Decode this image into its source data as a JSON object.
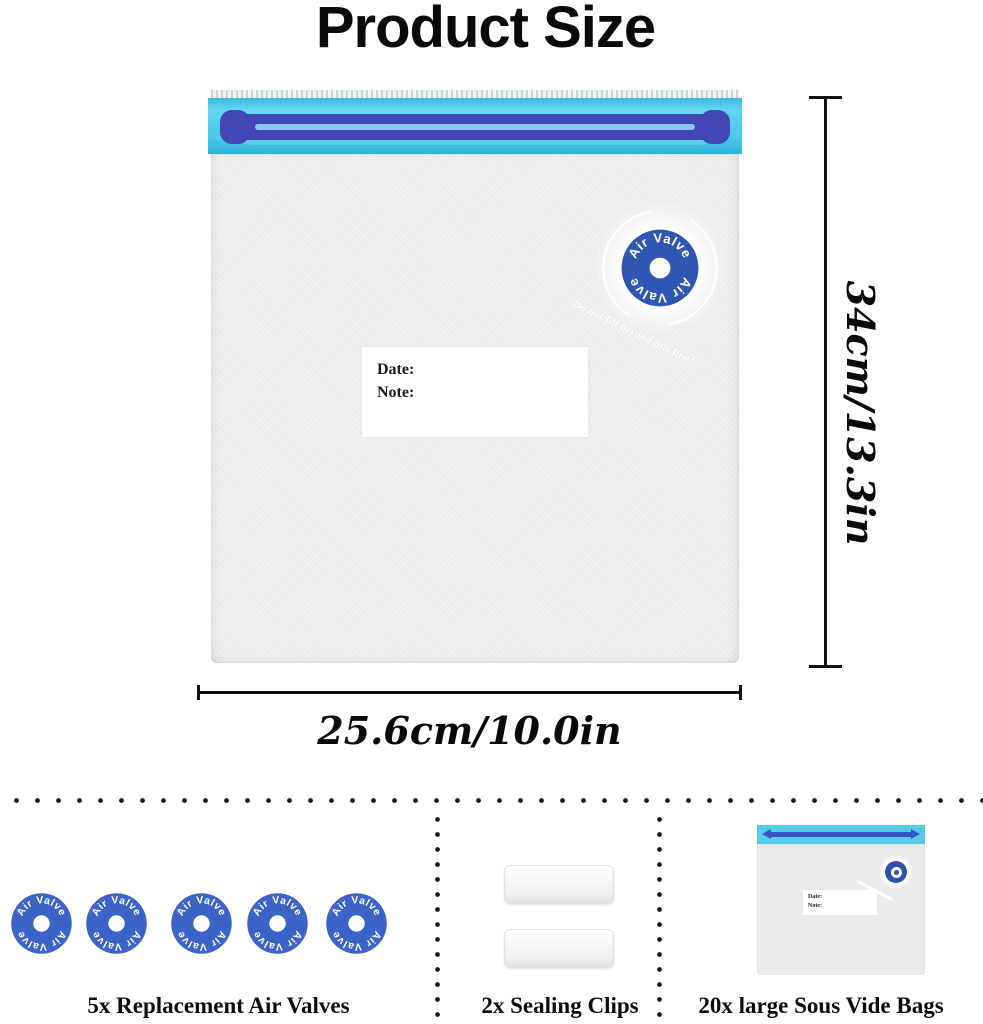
{
  "title": "Product Size",
  "bag": {
    "valve_text": "Air Valve",
    "warning_text": "Do not fill beyond this line!",
    "label": {
      "date": "Date:",
      "note": "Note:"
    },
    "dimensions": {
      "height": "34cm/13.3in",
      "width": "25.6cm/10.0in"
    }
  },
  "mini_bag": {
    "label": {
      "date": "Date:",
      "note": "Note:"
    }
  },
  "included_items": [
    {
      "icon": "air-valve-icon",
      "label": "5x Replacement Air Valves"
    },
    {
      "icon": "sealing-clip-icon",
      "label": "2x Sealing Clips"
    },
    {
      "icon": "sous-vide-bag-icon",
      "label": "20x large Sous Vide Bags"
    }
  ],
  "colors": {
    "seal_cyan": "#4ecae9",
    "zipper_blue": "#4247b5",
    "valve_blue": "#2f56b3",
    "valve_blue_small": "#3c63c8",
    "bag_gray": "#efefef",
    "text_black": "#0a0a0a"
  }
}
